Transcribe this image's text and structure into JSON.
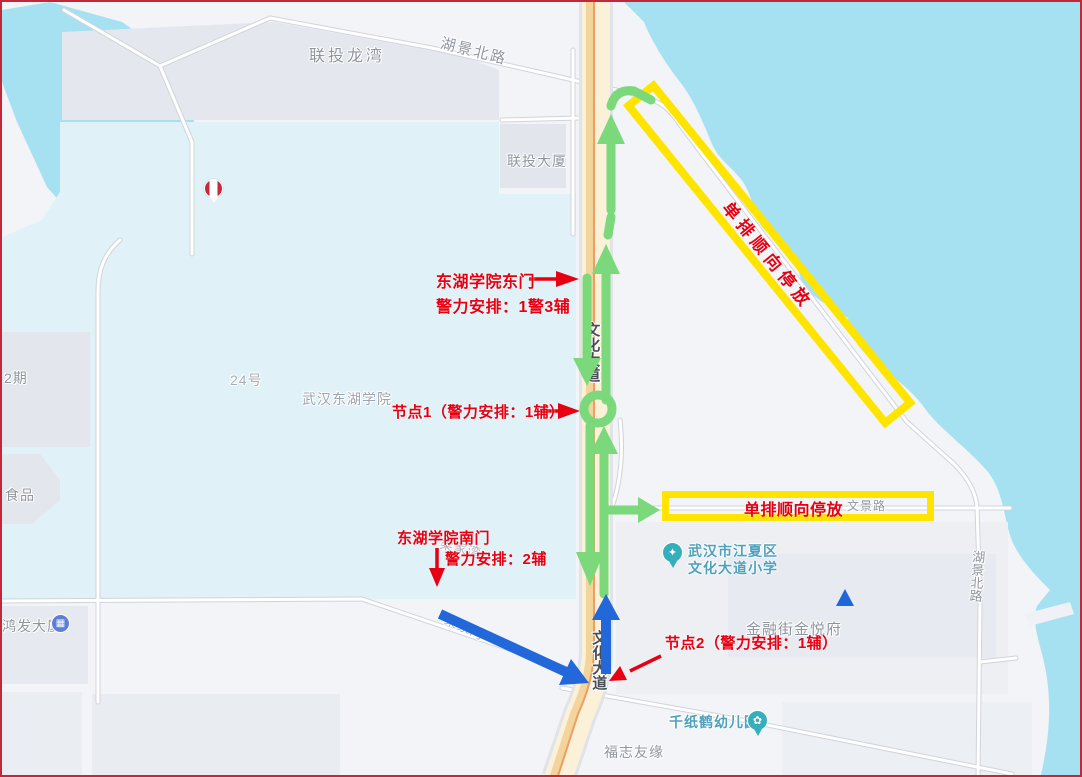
{
  "window": {
    "border_color": "#C0293A"
  },
  "map": {
    "colors": {
      "water": "#A6E1F2",
      "land": "#F2F4F7",
      "campus": "#E0F2F7",
      "block": "#E4E7ED",
      "road_fill": "#FFFFFF",
      "road_casing": "#D3D7DE",
      "highway_fill": "#FAF1D8",
      "highway_stripe": "#F3D49C",
      "route_green": "#7BD87B",
      "route_blue": "#2268DB",
      "annotation_red": "#E60012",
      "parking_yellow": "#FFE400"
    },
    "place_labels": {
      "liantou_longwan": "联投龙湾",
      "liantou_building": "联投大厦",
      "no24": "24号",
      "wuhan_donghu_college": "武汉东湖学院",
      "phase2": "2期",
      "food": "食品",
      "hongfa_building": "鸿发大厦",
      "fuzhi_youyuan": "福志友缘",
      "jinrongjie_jinyuefu": "金融街金悦府"
    },
    "road_labels": {
      "hujing_north_road_top": "湖景北路",
      "hujing_north_road_right": "湖景北路",
      "wenhua_avenue_upper": "文化大道",
      "wenhua_avenue_lower": "文化大道",
      "wenjing_road": "文景路",
      "liangjiawan_upper": "梁家湾",
      "liangjiawan_lower": "梁家湾"
    },
    "pois": {
      "school_line1": "武汉市江夏区",
      "school_line2": "文化大道小学",
      "kindergarten": "千纸鹤幼儿园"
    },
    "annotations": {
      "east_gate_title": "东湖学院东门",
      "east_gate_detail": "警力安排：1警3辅",
      "node1": "节点1（警力安排：1辅）",
      "south_gate_title": "东湖学院南门",
      "south_gate_detail": "警力安排：2辅",
      "node2": "节点2（警力安排：1辅）",
      "parking_diagonal": "单排顺向停放",
      "parking_horizontal": "单排顺向停放"
    }
  }
}
